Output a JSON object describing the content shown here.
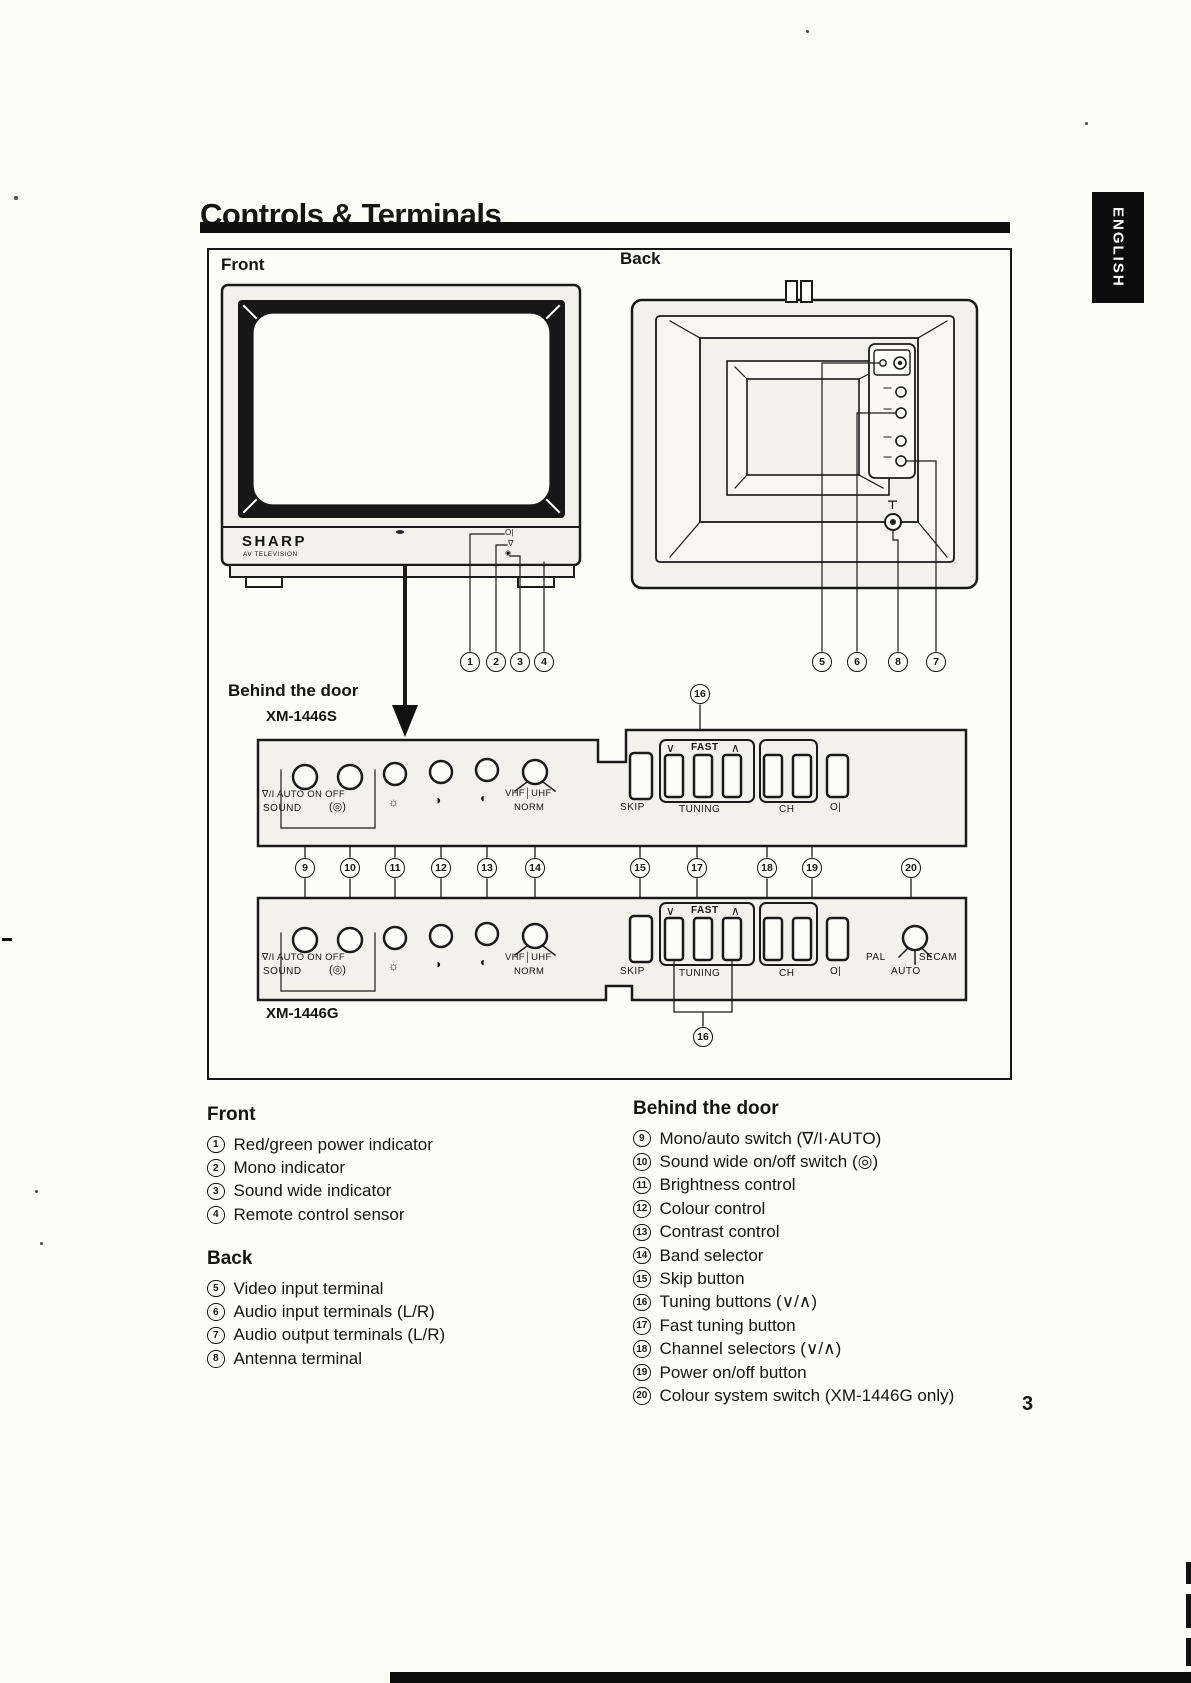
{
  "title": "Controls & Terminals",
  "language_tab": "ENGLISH",
  "page_number": "3",
  "diagram": {
    "front_label": "Front",
    "back_label": "Back",
    "behind_label": "Behind the door",
    "model_s": "XM-1446S",
    "model_g": "XM-1446G",
    "brand": "SHARP",
    "brand_sub": "AV TELEVISION",
    "indicator_glyphs": {
      "power": "Ο|",
      "mono": "∇",
      "wide": "◉"
    },
    "antenna_glyph": "⊤",
    "panel_labels": {
      "mono_auto": "∇/I  AUTO  ON OFF",
      "sound": "SOUND",
      "wide_icon": "(◎)",
      "brightness": "☼",
      "colour": "◑",
      "contrast": "◐",
      "band_top": "VHF│UHF",
      "band_bottom": "NORM",
      "down": "∨",
      "fast": "FAST",
      "up": "∧",
      "skip": "SKIP",
      "tuning": "TUNING",
      "ch": "CH",
      "power": "Ο|",
      "pal": "PAL",
      "secam": "SECAM",
      "auto": "AUTO"
    },
    "callouts": {
      "c1": "1",
      "c2": "2",
      "c3": "3",
      "c4": "4",
      "c5": "5",
      "c6": "6",
      "c7": "7",
      "c8": "8",
      "c9": "9",
      "c10": "10",
      "c11": "11",
      "c12": "12",
      "c13": "13",
      "c14": "14",
      "c15": "15",
      "c16": "16",
      "c17": "17",
      "c18": "18",
      "c19": "19",
      "c20": "20"
    }
  },
  "legend": {
    "front": {
      "heading": "Front",
      "items": [
        {
          "num": "1",
          "text": "Red/green power indicator"
        },
        {
          "num": "2",
          "text": "Mono indicator"
        },
        {
          "num": "3",
          "text": "Sound wide indicator"
        },
        {
          "num": "4",
          "text": "Remote control sensor"
        }
      ]
    },
    "back": {
      "heading": "Back",
      "items": [
        {
          "num": "5",
          "text": "Video input terminal"
        },
        {
          "num": "6",
          "text": "Audio input terminals (L/R)"
        },
        {
          "num": "7",
          "text": "Audio output terminals (L/R)"
        },
        {
          "num": "8",
          "text": "Antenna terminal"
        }
      ]
    },
    "behind": {
      "heading": "Behind the door",
      "items": [
        {
          "num": "9",
          "text": "Mono/auto switch (∇/I·AUTO)"
        },
        {
          "num": "10",
          "text": "Sound wide on/off switch (◎)"
        },
        {
          "num": "11",
          "text": "Brightness control"
        },
        {
          "num": "12",
          "text": "Colour control"
        },
        {
          "num": "13",
          "text": "Contrast control"
        },
        {
          "num": "14",
          "text": "Band selector"
        },
        {
          "num": "15",
          "text": "Skip button"
        },
        {
          "num": "16",
          "text": "Tuning buttons (∨/∧)"
        },
        {
          "num": "17",
          "text": "Fast tuning button"
        },
        {
          "num": "18",
          "text": "Channel selectors (∨/∧)"
        },
        {
          "num": "19",
          "text": "Power on/off button"
        },
        {
          "num": "20",
          "text": "Colour system switch (XM-1446G only)"
        }
      ]
    }
  }
}
